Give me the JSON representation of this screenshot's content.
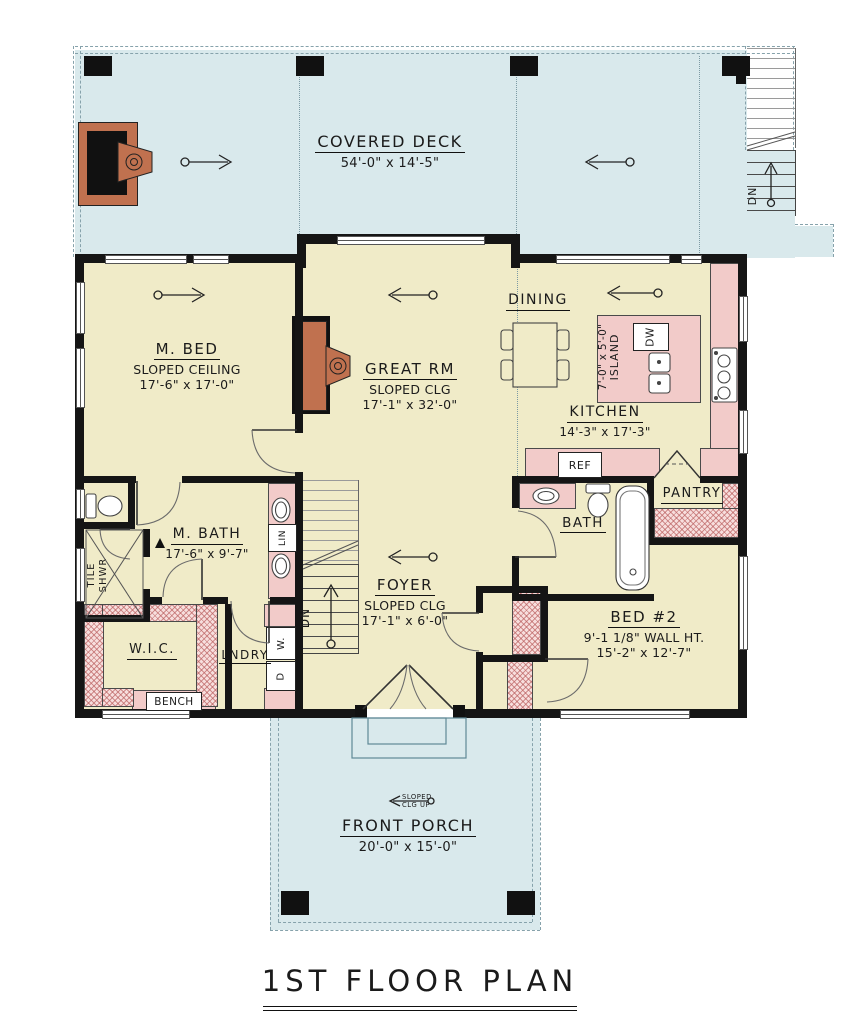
{
  "title": "1ST FLOOR PLAN",
  "colors": {
    "deck": "#d9e9ec",
    "interior": "#f0ebc8",
    "counter": "#f2cbc9",
    "hatch": "#f7dedd",
    "wall": "#151515",
    "fireplace": "#c0714f"
  },
  "rooms": {
    "covered_deck": {
      "name": "COVERED DECK",
      "dims": "54'-0\" x 14'-5\""
    },
    "m_bed": {
      "name": "M. BED",
      "sub": "SLOPED CEILING",
      "dims": "17'-6\" x 17'-0\""
    },
    "great_rm": {
      "name": "GREAT RM",
      "sub": "SLOPED CLG",
      "dims": "17'-1\" x 32'-0\""
    },
    "dining": {
      "name": "DINING"
    },
    "kitchen": {
      "name": "KITCHEN",
      "dims": "14'-3\" x 17'-3\""
    },
    "island": {
      "dims": "7'-0\" x 5'-0\"",
      "name": "ISLAND"
    },
    "m_bath": {
      "name": "M. BATH",
      "dims": "17'-6\" x 9'-7\""
    },
    "tile_shwr": {
      "line1": "TILE",
      "line2": "SHWR"
    },
    "foyer": {
      "name": "FOYER",
      "sub": "SLOPED CLG",
      "dims": "17'-1\" x 6'-0\""
    },
    "bath": {
      "name": "BATH"
    },
    "pantry": {
      "name": "PANTRY"
    },
    "bed2": {
      "name": "BED #2",
      "sub": "9'-1 1/8\" WALL HT.",
      "dims": "15'-2\" x 12'-7\""
    },
    "wic": {
      "name": "W.I.C."
    },
    "lndry": {
      "name": "LNDRY"
    },
    "front_porch": {
      "name": "FRONT PORCH",
      "dims": "20'-0\" x 15'-0\""
    }
  },
  "fixtures": {
    "ref": "REF",
    "dw": "DW",
    "lin": "LIN",
    "washer": "W.",
    "dryer": "D",
    "bench": "BENCH"
  },
  "notes": {
    "dn_stairs": "DN",
    "dn_ext": "DN",
    "slope_line1": "SLOPED",
    "slope_line2": "CLG UP"
  }
}
